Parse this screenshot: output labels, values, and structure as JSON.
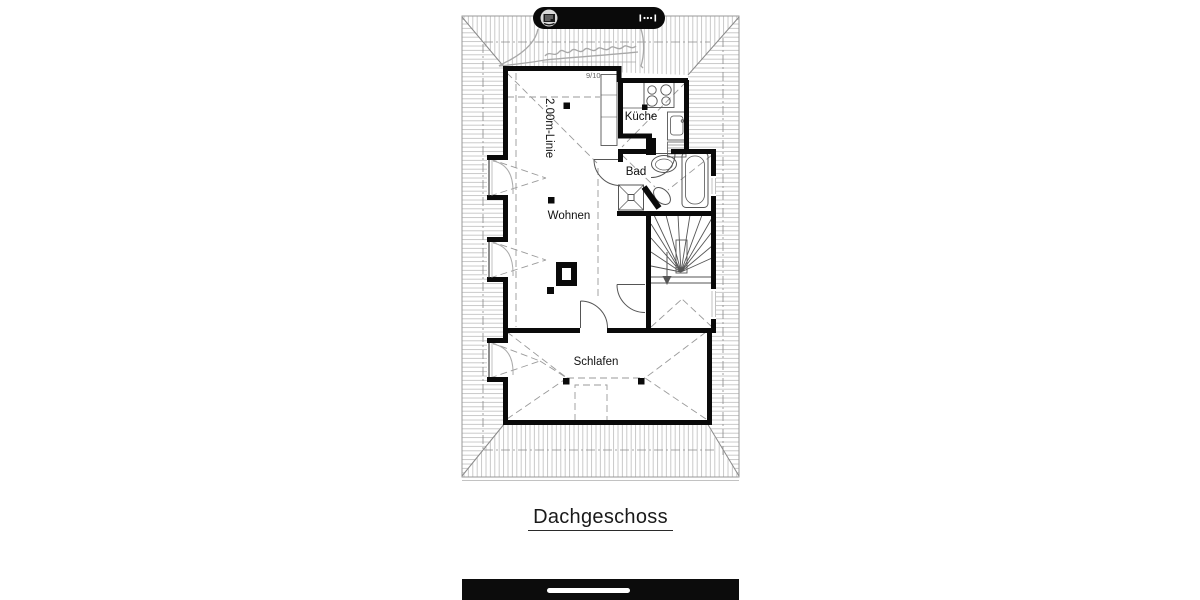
{
  "page": {
    "background": "#ffffff"
  },
  "toolbar_pill": {
    "logo_icon": "stamp-logo",
    "scale_icon": "measure-marks"
  },
  "plan": {
    "rooms": [
      {
        "id": "kueche",
        "label": "Küche"
      },
      {
        "id": "bad",
        "label": "Bad"
      },
      {
        "id": "wohnen",
        "label": "Wohnen"
      },
      {
        "id": "schlafen",
        "label": "Schlafen"
      }
    ],
    "annotations": {
      "height_line": "2.00m-Linie",
      "wall_note": "9/10"
    },
    "colors": {
      "wall": "#0a0a0a",
      "hatch": "#b3b3b3",
      "dashes": "#9a9a9a",
      "fixtures": "#555555",
      "text": "#111111"
    }
  },
  "caption": {
    "title": "Dachgeschoss"
  },
  "bottom_bar": {
    "handle_icon": "drag-handle"
  }
}
